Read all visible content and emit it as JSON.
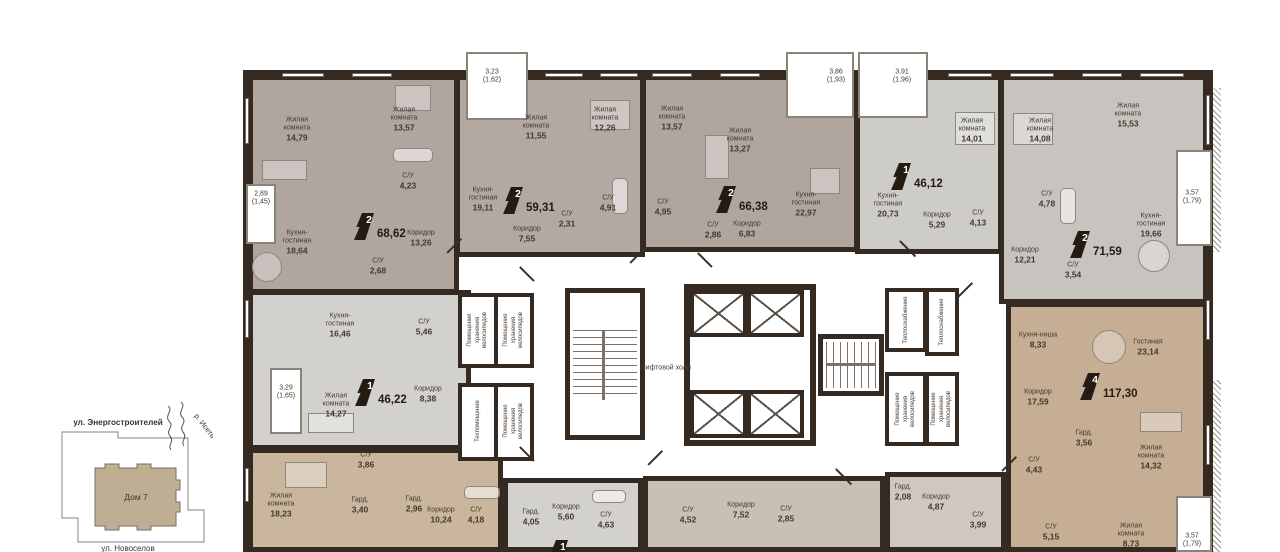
{
  "plan": {
    "apartments": [
      {
        "flag": "2",
        "total": "68,62",
        "rooms": [
          {
            "name": "Жилая комната",
            "area": "14,79"
          },
          {
            "name": "Жилая комната",
            "area": "13,57"
          },
          {
            "name": "С/У",
            "area": "4,23"
          },
          {
            "name": "Кухня-гостиная",
            "area": "18,64"
          },
          {
            "name": "Коридор",
            "area": "13,26"
          },
          {
            "name": "С/У",
            "area": "2,68"
          }
        ],
        "balcony": {
          "area": "2,89",
          "reduced": "(1,45)"
        }
      },
      {
        "flag": "2",
        "total": "59,31",
        "rooms": [
          {
            "name": "Жилая комната",
            "area": "11,55"
          },
          {
            "name": "Жилая комната",
            "area": "12,26"
          },
          {
            "name": "Кухня-гостиная",
            "area": "19,11"
          },
          {
            "name": "С/У",
            "area": "4,91"
          },
          {
            "name": "С/У",
            "area": "2,31"
          },
          {
            "name": "Коридор",
            "area": "7,55"
          }
        ],
        "balcony": {
          "area": "3,23",
          "reduced": "(1,62)"
        }
      },
      {
        "flag": "2",
        "total": "66,38",
        "rooms": [
          {
            "name": "Жилая комната",
            "area": "13,57"
          },
          {
            "name": "Жилая комната",
            "area": "13,27"
          },
          {
            "name": "С/У",
            "area": "4,95"
          },
          {
            "name": "С/У",
            "area": "2,86"
          },
          {
            "name": "Коридор",
            "area": "6,83"
          },
          {
            "name": "Кухня-гостиная",
            "area": "22,97"
          }
        ],
        "balcony": {
          "area": "3,86",
          "reduced": "(1,93)"
        }
      },
      {
        "flag": "1",
        "total": "46,12",
        "rooms": [
          {
            "name": "Жилая комната",
            "area": "14,01"
          },
          {
            "name": "Кухня-гостиная",
            "area": "20,73"
          },
          {
            "name": "Коридор",
            "area": "5,29"
          },
          {
            "name": "С/У",
            "area": "4,13"
          }
        ],
        "balcony": {
          "area": "3,91",
          "reduced": "(1,96)"
        }
      },
      {
        "flag": "2",
        "total": "71,59",
        "rooms": [
          {
            "name": "Жилая комната",
            "area": "14,08"
          },
          {
            "name": "Жилая комната",
            "area": "15,53"
          },
          {
            "name": "С/У",
            "area": "4,78"
          },
          {
            "name": "Кухня-гостиная",
            "area": "19,66"
          },
          {
            "name": "Коридор",
            "area": "12,21"
          },
          {
            "name": "С/У",
            "area": "3,54"
          }
        ],
        "balcony": {
          "area": "3,57",
          "reduced": "(1,79)"
        }
      },
      {
        "flag": "1",
        "total": "46,22",
        "rooms": [
          {
            "name": "Кухня-гостиная",
            "area": "16,46"
          },
          {
            "name": "С/У",
            "area": "5,46"
          },
          {
            "name": "Жилая комната",
            "area": "14,27"
          },
          {
            "name": "Коридор",
            "area": "8,38"
          }
        ],
        "balcony": {
          "area": "3,29",
          "reduced": "(1,65)"
        }
      },
      {
        "flag": "4",
        "total": "117,30",
        "rooms": [
          {
            "name": "Кухня-ниша",
            "area": "8,33"
          },
          {
            "name": "Гостиная",
            "area": "23,14"
          },
          {
            "name": "Коридор",
            "area": "17,59"
          },
          {
            "name": "Гард.",
            "area": "3,56"
          },
          {
            "name": "С/У",
            "area": "4,43"
          },
          {
            "name": "Жилая комната",
            "area": "14,32"
          },
          {
            "name": "С/У",
            "area": "5,15"
          },
          {
            "name": "Жилая комната",
            "area": "8,73"
          }
        ],
        "balcony": {
          "area": "3,57",
          "reduced": "(1,79)"
        }
      },
      {
        "rooms": [
          {
            "name": "Жилая комната",
            "area": "18,23"
          },
          {
            "name": "С/У",
            "area": "3,86"
          },
          {
            "name": "Гард.",
            "area": "3,40"
          },
          {
            "name": "Гард.",
            "area": "2,96"
          },
          {
            "name": "Коридор",
            "area": "10,24"
          },
          {
            "name": "С/У",
            "area": "4,18"
          }
        ]
      },
      {
        "flag": "1",
        "rooms": [
          {
            "name": "Гард.",
            "area": "4,05"
          },
          {
            "name": "Коридор",
            "area": "5,60"
          },
          {
            "name": "С/У",
            "area": "4,63"
          }
        ]
      },
      {
        "rooms": [
          {
            "name": "С/У",
            "area": "4,52"
          },
          {
            "name": "Коридор",
            "area": "7,52"
          },
          {
            "name": "С/У",
            "area": "2,85"
          }
        ]
      },
      {
        "rooms": [
          {
            "name": "Гард.",
            "area": "2,08"
          },
          {
            "name": "Коридор",
            "area": "4,87"
          },
          {
            "name": "С/У",
            "area": "3,99"
          }
        ]
      }
    ],
    "common": {
      "lift_hall": "Лифтовой холл",
      "bike_storage": "Помещение хранения велосипедов",
      "tech_room": "Техпомещение",
      "heat_room": "Теплоснабжение"
    }
  },
  "site_plan": {
    "street_top": "ул. Энергостроителей",
    "river": "р. Исеть",
    "building": "Дом 7",
    "street_bottom": "ул. Новоселов"
  },
  "colors": {
    "wall": "#342a21",
    "apt_mauve": "#b1a5a0",
    "apt_gray_light": "#d2d1cd",
    "apt_gray": "#c7c4bf",
    "apt_tan": "#c6ae94",
    "apt_tan_light": "#c9b69c",
    "apt_warm_gray": "#cabfb5"
  }
}
